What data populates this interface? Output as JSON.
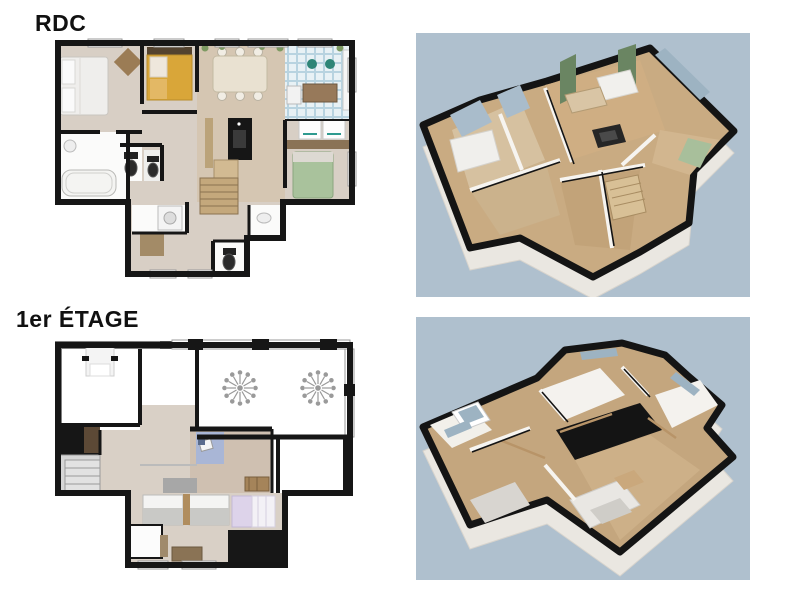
{
  "labels": {
    "ground_floor": "RDC",
    "first_floor": "1er ÉTAGE"
  },
  "colors": {
    "page_background": "#ffffff",
    "render_background": "#afc0ce",
    "wall_black": "#161616",
    "floor_beige": "#d8cfc5",
    "floor_wood": "#d5c6b2",
    "floor_white": "#fbfbfa",
    "kitchen_tile_blue": "#b8d3e0",
    "bed_yellow": "#d9a639",
    "bed_green": "#a9c29c",
    "bed_lavender": "#e6e1f1",
    "rug_blue": "#a9b6d6",
    "furniture_brown": "#8a7356",
    "curtain_green": "#6a8562",
    "window_blue": "#9db3c2",
    "stair_gray": "#d6d6d6",
    "label_color": "#111111"
  }
}
